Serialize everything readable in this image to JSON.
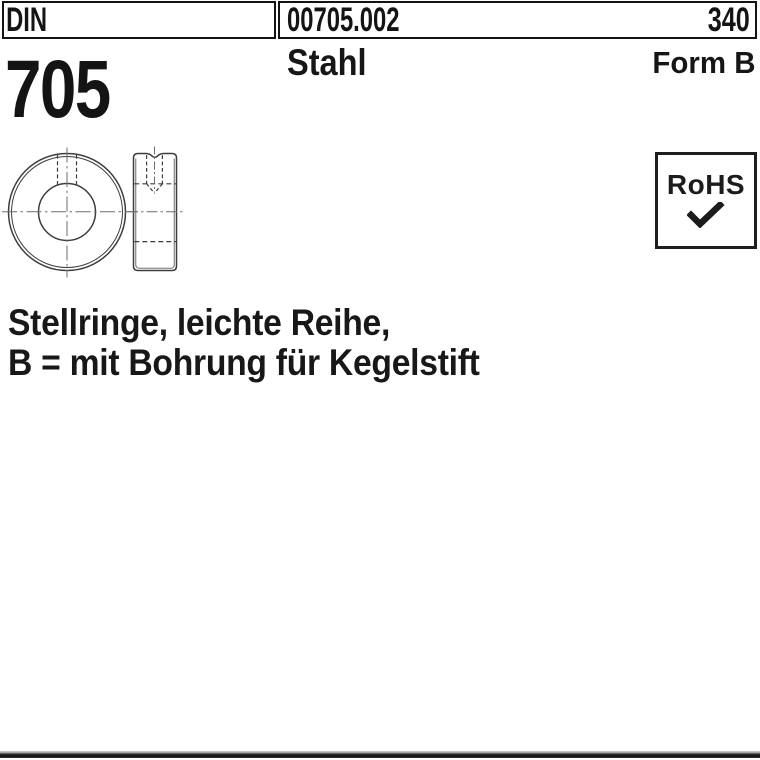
{
  "header": {
    "din_label": "DIN",
    "article_number": "00705.002",
    "page_number": "340",
    "standard_number": "705",
    "material": "Stahl",
    "form_label": "Form B"
  },
  "rohs_badge": {
    "label": "RoHS",
    "icon": "checkmark-icon"
  },
  "description": {
    "line1": "Stellringe, leichte Reihe,",
    "line2": "B = mit Bohrung für Kegelstift"
  },
  "drawing": {
    "name": "stellring-technical-drawing",
    "views": [
      "front-view",
      "side-section-view"
    ]
  },
  "colors": {
    "ink": "#141414",
    "drawing_stroke": "#3d3d3d",
    "centerline_stroke": "#6e6e6e",
    "background": "#ffffff",
    "bottom_bar_dark": "#101010",
    "bottom_bar_light": "#d2d2d2"
  }
}
